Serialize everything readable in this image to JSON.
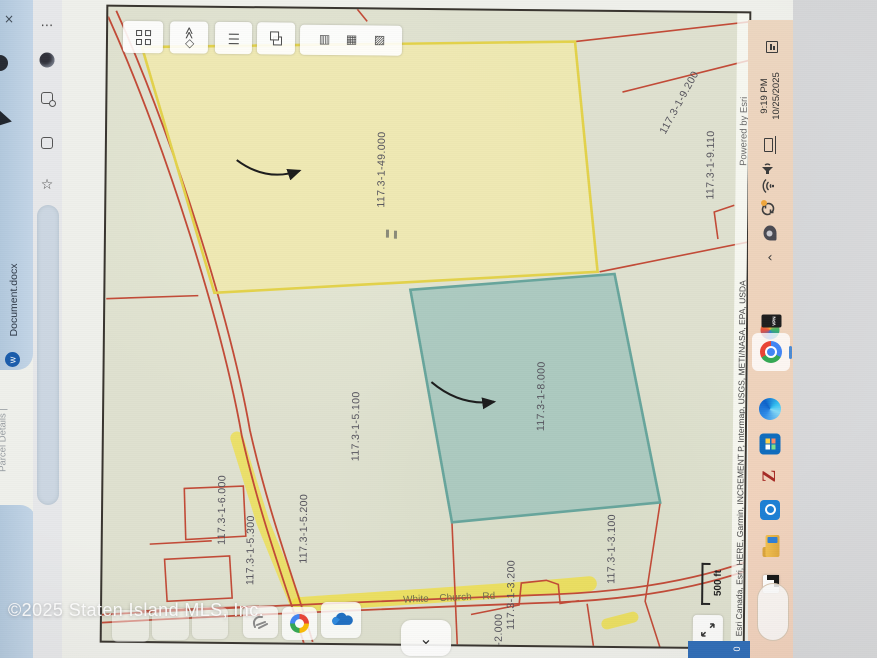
{
  "watermark": {
    "text": "©2025 Staten Island MLS, Inc."
  },
  "browser": {
    "tab_document": "Document.docx",
    "tab_partial": "Parcel Details |",
    "word_initial": "w"
  },
  "icons": {
    "menu_dots": "⋯",
    "star": "☆",
    "close": "×",
    "chevron_left": "‹",
    "chevron_down": "⌄",
    "diamond_chevrons": "◇≫",
    "bars": "|||",
    "stack": [
      "▤",
      "▦",
      "▧"
    ]
  },
  "map": {
    "labels": [
      "117.3-1-49.000",
      "117.3-1-8.000",
      "117.3-1-5.100",
      "117.3-1-6.000",
      "117.3-1-5.300",
      "117.3-1-5.200",
      "117.3-1-3.200",
      "117.3-1-3.100",
      "117.3-1-9.110",
      "117.3-1-9.200",
      "1-2.000"
    ],
    "road_name": "White Church Rd",
    "scale_label": "500 ft",
    "powered_by": "Powered by Esri",
    "attribution": "Esri Canada, Esri, HERE, Garmin, INCREMENT P, Intermap, USGS, METI/NASA, EPA, USDA",
    "colors": {
      "parcel_line": "#c24a37",
      "highlight_yellow": "#f0df3e",
      "parcel_yellow_fill": "#f0e9ae",
      "parcel_yellow_border": "#e3d24b",
      "parcel_teal_fill": "#a6c7be",
      "parcel_teal_border": "#67a59c"
    }
  },
  "taskbar": {
    "time": "9:19 PM",
    "date": "10/25/2025",
    "vpn_badge": "VPN"
  },
  "statusbar": {
    "value": "0"
  }
}
